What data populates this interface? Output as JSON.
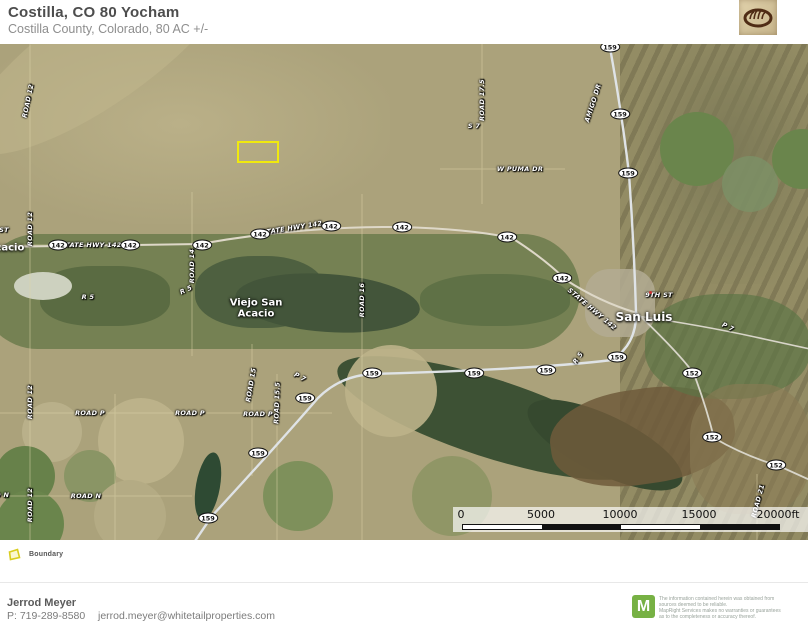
{
  "header": {
    "title": "Costilla, CO 80 Yocham",
    "subtitle": "Costilla County, Colorado, 80 AC +/-",
    "logo_name": "whitetail-properties-emblem"
  },
  "map": {
    "boundary_feature": "Boundary",
    "shields": [
      {
        "label": "142",
        "x": 58,
        "y": 201
      },
      {
        "label": "142",
        "x": 130,
        "y": 201
      },
      {
        "label": "142",
        "x": 202,
        "y": 201
      },
      {
        "label": "142",
        "x": 260,
        "y": 190
      },
      {
        "label": "142",
        "x": 331,
        "y": 182
      },
      {
        "label": "142",
        "x": 402,
        "y": 183
      },
      {
        "label": "142",
        "x": 507,
        "y": 193
      },
      {
        "label": "142",
        "x": 562,
        "y": 234
      },
      {
        "label": "159",
        "x": 610,
        "y": 3
      },
      {
        "label": "159",
        "x": 620,
        "y": 70
      },
      {
        "label": "159",
        "x": 628,
        "y": 129
      },
      {
        "label": "159",
        "x": 617,
        "y": 313
      },
      {
        "label": "159",
        "x": 546,
        "y": 326
      },
      {
        "label": "159",
        "x": 474,
        "y": 329
      },
      {
        "label": "159",
        "x": 372,
        "y": 329
      },
      {
        "label": "159",
        "x": 305,
        "y": 354
      },
      {
        "label": "159",
        "x": 258,
        "y": 409
      },
      {
        "label": "159",
        "x": 208,
        "y": 474
      },
      {
        "label": "152",
        "x": 692,
        "y": 329
      },
      {
        "label": "152",
        "x": 712,
        "y": 393
      },
      {
        "label": "152",
        "x": 776,
        "y": 421
      }
    ],
    "road_labels": [
      {
        "text": "ROAD 12",
        "x": 28,
        "y": 57,
        "rot": -78
      },
      {
        "text": "ST",
        "x": 4,
        "y": 186,
        "rot": 0
      },
      {
        "text": "ROAD 12",
        "x": 30,
        "y": 185,
        "rot": -90
      },
      {
        "text": "ROAD 12",
        "x": 30,
        "y": 358,
        "rot": -90
      },
      {
        "text": "ROAD 12",
        "x": 30,
        "y": 461,
        "rot": -90
      },
      {
        "text": "STATE HWY 142",
        "x": 91,
        "y": 201,
        "rot": 0
      },
      {
        "text": "ROAD 14",
        "x": 192,
        "y": 222,
        "rot": -90
      },
      {
        "text": "R 5",
        "x": 88,
        "y": 253,
        "rot": 0
      },
      {
        "text": "R 5",
        "x": 186,
        "y": 246,
        "rot": -25
      },
      {
        "text": "STATE HWY 142",
        "x": 292,
        "y": 184,
        "rot": -9
      },
      {
        "text": "ROAD 16",
        "x": 362,
        "y": 256,
        "rot": -90
      },
      {
        "text": "ROAD 17.5",
        "x": 482,
        "y": 56,
        "rot": -90
      },
      {
        "text": "S 7",
        "x": 474,
        "y": 82,
        "rot": 0
      },
      {
        "text": "W PUMA DR",
        "x": 520,
        "y": 125,
        "rot": 0
      },
      {
        "text": "AMIGO DR",
        "x": 593,
        "y": 59,
        "rot": -72
      },
      {
        "text": "STATE HWY 142",
        "x": 592,
        "y": 265,
        "rot": 40
      },
      {
        "text": "9TH ST",
        "x": 659,
        "y": 251,
        "rot": 0
      },
      {
        "text": "P 7",
        "x": 728,
        "y": 283,
        "rot": 25
      },
      {
        "text": "R 5",
        "x": 578,
        "y": 314,
        "rot": -55
      },
      {
        "text": "P 7",
        "x": 300,
        "y": 333,
        "rot": 28
      },
      {
        "text": "ROAD 15",
        "x": 251,
        "y": 341,
        "rot": -80
      },
      {
        "text": "ROAD 15.5",
        "x": 277,
        "y": 359,
        "rot": -88
      },
      {
        "text": "ROAD P",
        "x": 90,
        "y": 369,
        "rot": 0
      },
      {
        "text": "ROAD P",
        "x": 190,
        "y": 369,
        "rot": 0
      },
      {
        "text": "ROAD P",
        "x": 258,
        "y": 370,
        "rot": 0
      },
      {
        "text": "ROAD N",
        "x": -6,
        "y": 451,
        "rot": 0
      },
      {
        "text": "ROAD N",
        "x": 86,
        "y": 452,
        "rot": 0
      },
      {
        "text": "ROAD 21",
        "x": 758,
        "y": 457,
        "rot": -75
      }
    ],
    "place_labels": [
      {
        "text": "Acacio",
        "x": 6,
        "y": 204,
        "size": 10
      },
      {
        "text": "Viejo San",
        "x": 256,
        "y": 259,
        "size": 10
      },
      {
        "text": "Acacio",
        "x": 256,
        "y": 270,
        "size": 10
      },
      {
        "text": "San Luis",
        "x": 644,
        "y": 273,
        "size": 12
      }
    ],
    "scalebar": {
      "ticks": [
        "0",
        "5000",
        "10000",
        "15000",
        "20000ft"
      ]
    }
  },
  "legend": {
    "items": [
      {
        "label": "Boundary",
        "color": "#f0e90e"
      }
    ]
  },
  "footer": {
    "agent_name": "Jerrod Meyer",
    "agent_phone": "P: 719-289-8580",
    "agent_email": "jerrod.meyer@whitetailproperties.com"
  },
  "attribution": {
    "logo_letter": "M",
    "logo_color": "#77b144",
    "lines": [
      "The information contained herein was obtained from",
      "sources deemed to be reliable.",
      " MapRight Services makes no warranties or guarantees",
      "as to the completeness or accuracy thereof."
    ]
  }
}
